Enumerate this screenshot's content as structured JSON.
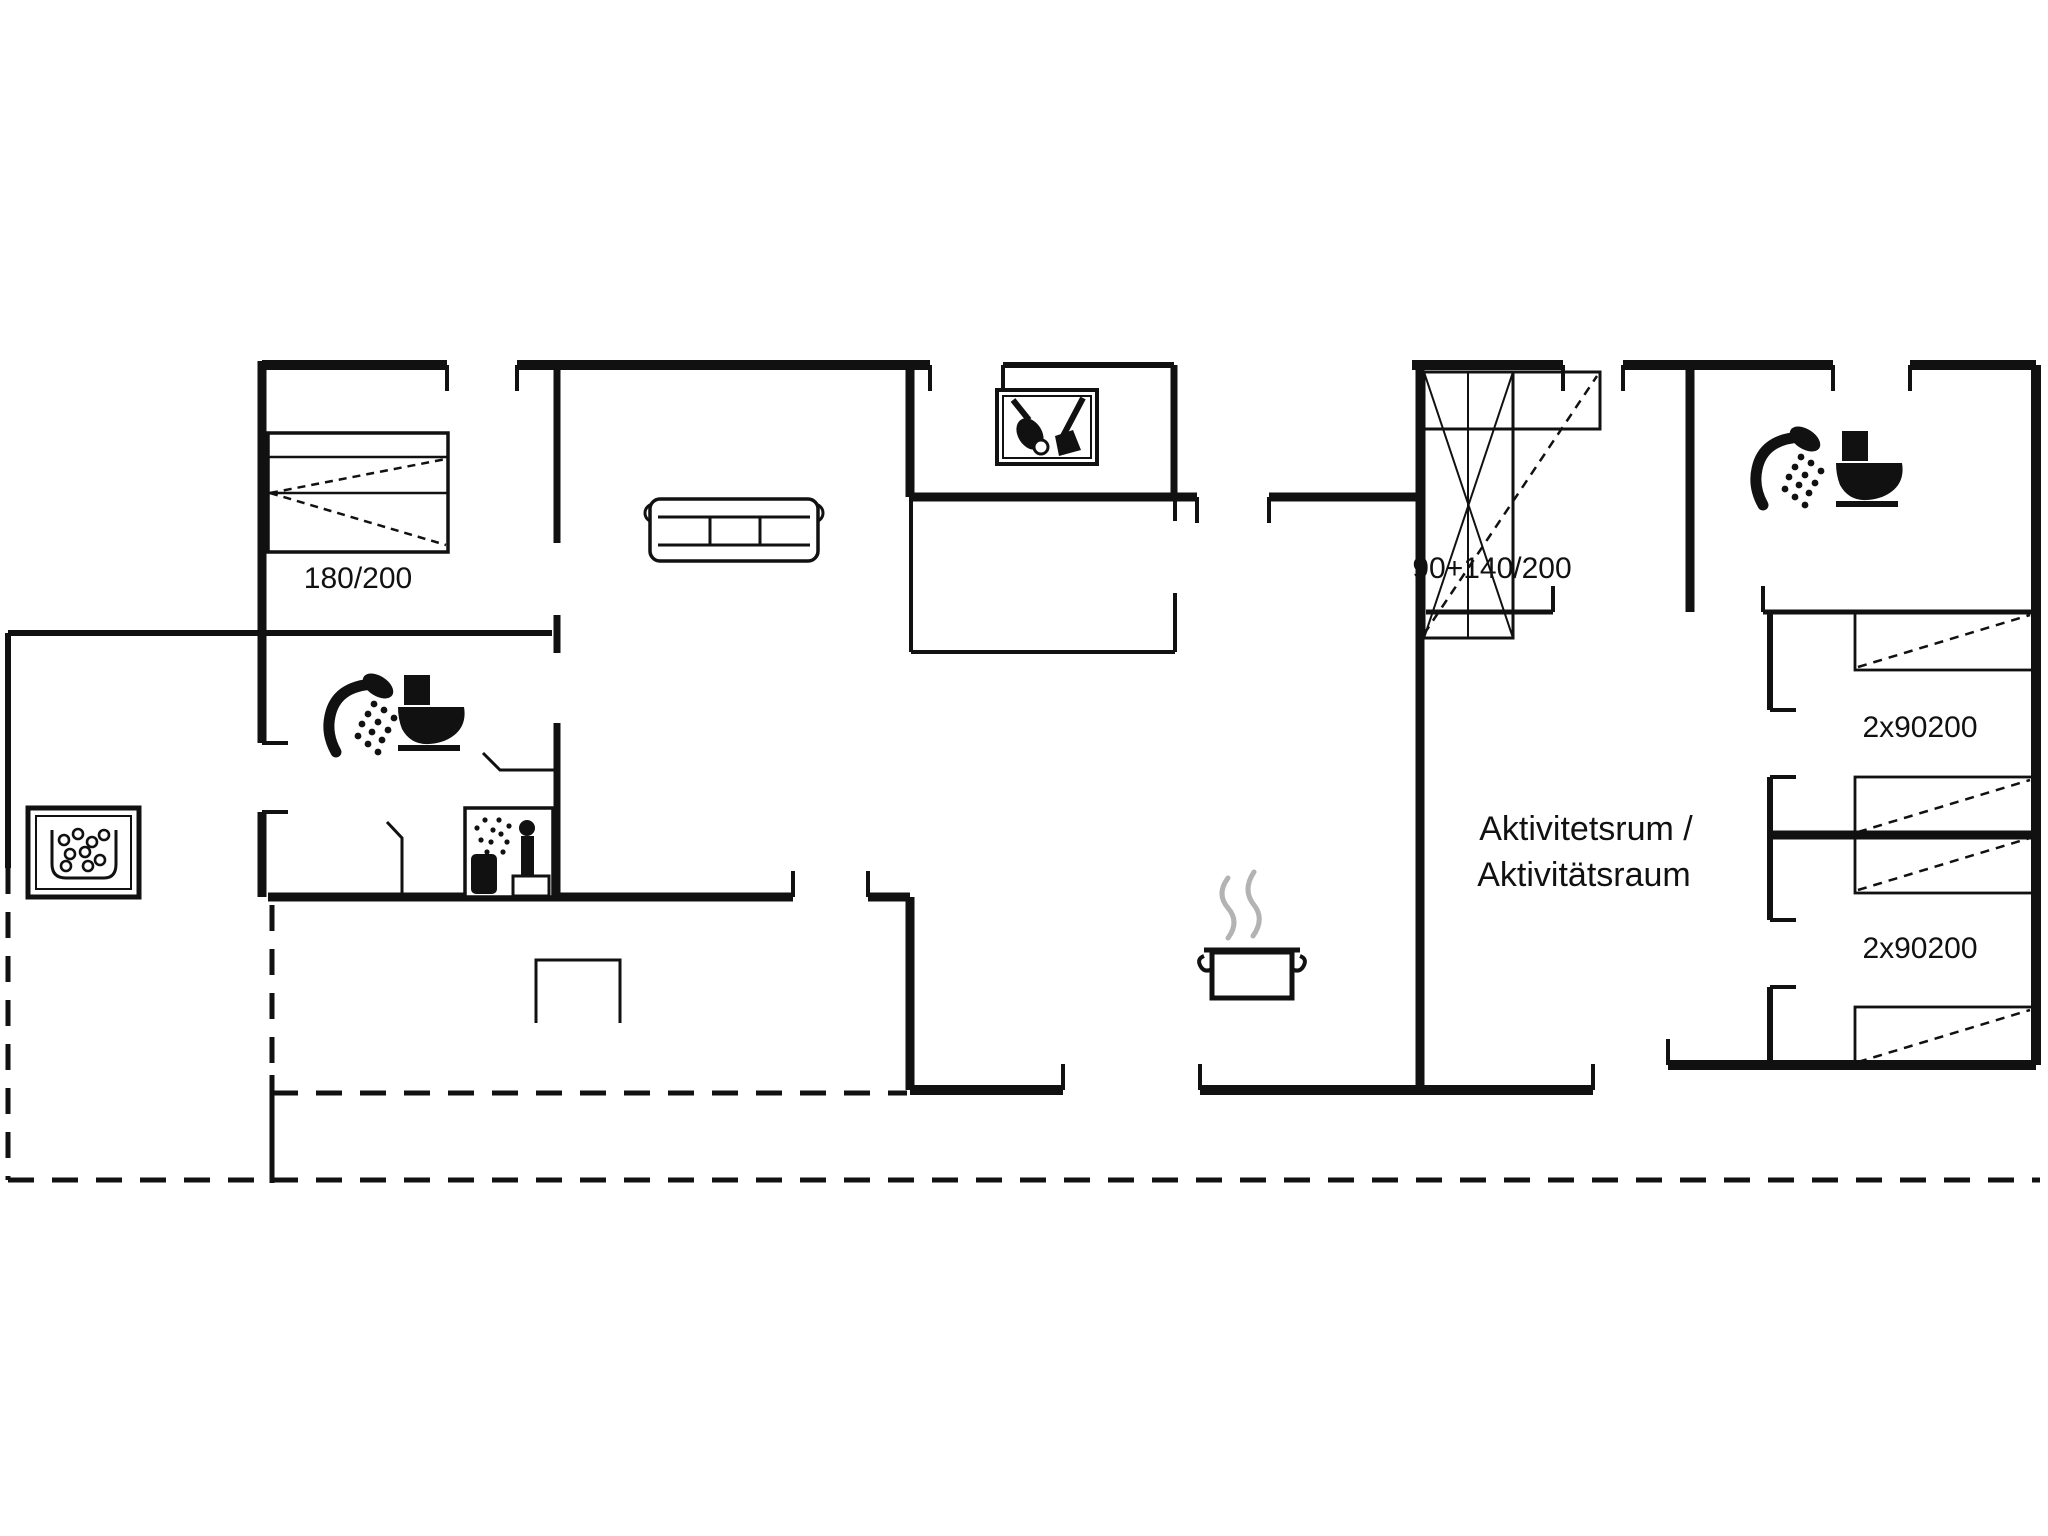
{
  "document": {
    "type": "floor-plan-drawing",
    "background": "#ffffff",
    "line_color": "#111111",
    "steam_color": "#b3b3b3"
  },
  "labels": [
    {
      "text": "180/200",
      "x": 358,
      "y": 588,
      "size": 30
    },
    {
      "text": "90+140/200",
      "x": 1492,
      "y": 578,
      "size": 30
    },
    {
      "text": "Aktivitetsrum /",
      "x": 1586,
      "y": 840,
      "size": 34
    },
    {
      "text": "Aktivitätsraum",
      "x": 1584,
      "y": 886,
      "size": 34
    },
    {
      "text": "2x90200",
      "x": 1920,
      "y": 737,
      "size": 30
    },
    {
      "text": "2x90200",
      "x": 1920,
      "y": 958,
      "size": 30
    }
  ],
  "icons": [
    {
      "name": "double-bed-icon",
      "x": 268,
      "y": 433
    },
    {
      "name": "sofa-icon",
      "x": 648,
      "y": 497
    },
    {
      "name": "cleaning-closet-icon",
      "x": 997,
      "y": 390
    },
    {
      "name": "window-bed-icon",
      "x": 1424,
      "y": 372
    },
    {
      "name": "shower-icon",
      "x": 316,
      "y": 672
    },
    {
      "name": "toilet-icon",
      "x": 398,
      "y": 675
    },
    {
      "name": "sauna-icon",
      "x": 465,
      "y": 808
    },
    {
      "name": "hot-tub-icon",
      "x": 28,
      "y": 808
    },
    {
      "name": "shower-icon",
      "x": 1743,
      "y": 425
    },
    {
      "name": "toilet-icon",
      "x": 1836,
      "y": 431
    },
    {
      "name": "cooking-pot-icon",
      "x": 1198,
      "y": 872
    },
    {
      "name": "terrace-table-icon",
      "x": 536,
      "y": 960
    },
    {
      "name": "single-bed-icon",
      "x": 1855,
      "y": 612
    },
    {
      "name": "single-bed-icon",
      "x": 1855,
      "y": 777
    },
    {
      "name": "single-bed-icon",
      "x": 1855,
      "y": 835
    },
    {
      "name": "single-bed-icon",
      "x": 1855,
      "y": 1007
    }
  ],
  "plan": {
    "walls": [
      [
        262,
        365,
        447,
        365,
        10
      ],
      [
        517,
        365,
        930,
        365,
        10
      ],
      [
        1003,
        365,
        1174,
        365,
        6
      ],
      [
        1412,
        365,
        1563,
        365,
        10
      ],
      [
        1623,
        365,
        1833,
        365,
        10
      ],
      [
        1910,
        365,
        2036,
        365,
        10
      ],
      [
        2036,
        365,
        2036,
        1065,
        10
      ],
      [
        262,
        361,
        262,
        743,
        9
      ],
      [
        262,
        812,
        262,
        897,
        9
      ],
      [
        910,
        365,
        910,
        497,
        9
      ],
      [
        1174,
        365,
        1174,
        497,
        7
      ],
      [
        910,
        497,
        1197,
        497,
        9
      ],
      [
        1269,
        497,
        1420,
        497,
        9
      ],
      [
        1420,
        365,
        1420,
        1090,
        9
      ],
      [
        1690,
        365,
        1690,
        612,
        9
      ],
      [
        8,
        633,
        552,
        633,
        6
      ],
      [
        8,
        633,
        8,
        868,
        6
      ],
      [
        557,
        370,
        557,
        543,
        7
      ],
      [
        557,
        615,
        557,
        653,
        7
      ],
      [
        557,
        723,
        557,
        897,
        7
      ],
      [
        268,
        897,
        793,
        897,
        9
      ],
      [
        868,
        897,
        910,
        897,
        9
      ],
      [
        910,
        897,
        910,
        1090,
        9
      ],
      [
        910,
        1090,
        1063,
        1090,
        10
      ],
      [
        1200,
        1090,
        1593,
        1090,
        10
      ],
      [
        1668,
        1065,
        2036,
        1065,
        10
      ],
      [
        1426,
        612,
        1553,
        612,
        5
      ],
      [
        1763,
        612,
        2036,
        612,
        5
      ],
      [
        1770,
        612,
        1770,
        710,
        6
      ],
      [
        1770,
        777,
        1770,
        920,
        6
      ],
      [
        1770,
        987,
        1770,
        1065,
        6
      ],
      [
        1770,
        835,
        2036,
        835,
        9
      ],
      [
        911,
        497,
        911,
        652,
        4
      ],
      [
        911,
        652,
        1175,
        652,
        4
      ],
      [
        1175,
        497,
        1175,
        521,
        4
      ],
      [
        1175,
        593,
        1175,
        652,
        4
      ],
      [
        272,
        1075,
        272,
        1183,
        5
      ]
    ],
    "dashed_walls": [
      [
        8,
        868,
        8,
        1180,
        5
      ],
      [
        8,
        1180,
        2040,
        1180,
        5
      ],
      [
        272,
        905,
        272,
        1075,
        5
      ],
      [
        272,
        1093,
        907,
        1093,
        5
      ]
    ],
    "ticks": [
      [
        447,
        365,
        447,
        391
      ],
      [
        517,
        365,
        517,
        391
      ],
      [
        930,
        365,
        930,
        391
      ],
      [
        1003,
        365,
        1003,
        391
      ],
      [
        1563,
        365,
        1563,
        391
      ],
      [
        1623,
        365,
        1623,
        391
      ],
      [
        1833,
        365,
        1833,
        391
      ],
      [
        1910,
        365,
        1910,
        391
      ],
      [
        1197,
        497,
        1197,
        523
      ],
      [
        1269,
        497,
        1269,
        523
      ],
      [
        793,
        871,
        793,
        897
      ],
      [
        868,
        871,
        868,
        897
      ],
      [
        1063,
        1064,
        1063,
        1090
      ],
      [
        1200,
        1064,
        1200,
        1090
      ],
      [
        1593,
        1064,
        1593,
        1090
      ],
      [
        1668,
        1039,
        1668,
        1065
      ],
      [
        1553,
        586,
        1553,
        612
      ],
      [
        1763,
        586,
        1763,
        612
      ],
      [
        1770,
        710,
        1796,
        710
      ],
      [
        1770,
        777,
        1796,
        777
      ],
      [
        1770,
        920,
        1796,
        920
      ],
      [
        1770,
        987,
        1796,
        987
      ],
      [
        262,
        743,
        288,
        743
      ],
      [
        262,
        812,
        288,
        812
      ]
    ],
    "door_leaves": [
      [
        [
          557,
          770
        ],
        [
          500,
          770
        ],
        [
          483,
          753
        ]
      ],
      [
        [
          402,
          897
        ],
        [
          402,
          838
        ],
        [
          387,
          822
        ]
      ]
    ],
    "single_beds": [
      [
        1855,
        612,
        178,
        58
      ],
      [
        1855,
        777,
        178,
        58
      ],
      [
        1855,
        835,
        178,
        58
      ],
      [
        1855,
        1007,
        178,
        58
      ]
    ]
  }
}
